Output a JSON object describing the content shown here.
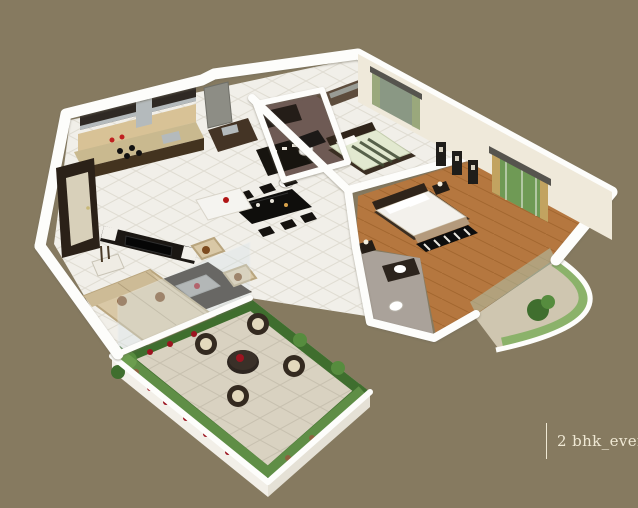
{
  "caption": {
    "text": "2 bhk_even"
  },
  "colors": {
    "background": "#867a60",
    "caption_text": "#efe8d4",
    "wall": "#fdfdfb",
    "wall_face": "#efe9da",
    "tile_floor": "#f1efe9",
    "wood_floor": "#b5773f",
    "terrace_floor": "#d9d2c1",
    "bath1_floor": "#6e5a54",
    "bath2_floor": "#aaa29a",
    "sofa": "#d9c8a6",
    "dark_furniture": "#1b1713",
    "counter_brown": "#43331f",
    "steel": "#b4babc",
    "plant_green": "#3f6e2e",
    "flower_red": "#9c1420",
    "glass_green": "#7fae5e",
    "curtain_green": "#9aa87c",
    "curtain_gold": "#c2a360",
    "bedding_green": "#e2e9d0",
    "mattress_white": "#f3f1ec"
  },
  "scene": {
    "type": "isometric-3d-floor-plan",
    "unit": "2 BHK apartment",
    "rooms": [
      {
        "name": "kitchen",
        "position": "top-left",
        "features": [
          "l-shaped-counter",
          "gas-hob",
          "steel-sink",
          "overhead-cabinets",
          "chimney-hood",
          "white-island-unit"
        ]
      },
      {
        "name": "entrance",
        "position": "left",
        "features": [
          "dark-main-door",
          "console-table-with-vases"
        ]
      },
      {
        "name": "living-room",
        "position": "center-left",
        "features": [
          "beige-l-shaped-sofa",
          "two-armchairs",
          "glass-coffee-table",
          "dark-area-rug",
          "tv-unit"
        ]
      },
      {
        "name": "dining-area",
        "position": "center",
        "features": [
          "dark-six-seater-table",
          "crockery-unit",
          "washbasin"
        ]
      },
      {
        "name": "common-bathroom",
        "position": "center-top",
        "features": [
          "toilet",
          "vanity"
        ]
      },
      {
        "name": "bedroom-1",
        "position": "top-right",
        "features": [
          "double-bed-green-striped-bedding",
          "mirror-sliding-wardrobe",
          "window-with-green-curtains",
          "tv-console"
        ]
      },
      {
        "name": "master-bedroom",
        "position": "right",
        "features": [
          "wooden-flooring",
          "double-bed-white-bedding",
          "black-white-foot-runner",
          "bedside-tables",
          "three-wall-art-frames",
          "french-window-gold-curtains"
        ]
      },
      {
        "name": "master-bathroom",
        "position": "center-right",
        "features": [
          "toilet",
          "washbasin-counter"
        ]
      },
      {
        "name": "terrace",
        "position": "bottom-center",
        "features": [
          "round-table",
          "four-wicker-chairs",
          "perimeter-planters-red-flowers",
          "green-glass-railing"
        ]
      },
      {
        "name": "curved-balcony",
        "position": "bottom-right",
        "features": [
          "curved-green-glass-railing",
          "potted-plant"
        ]
      }
    ]
  }
}
